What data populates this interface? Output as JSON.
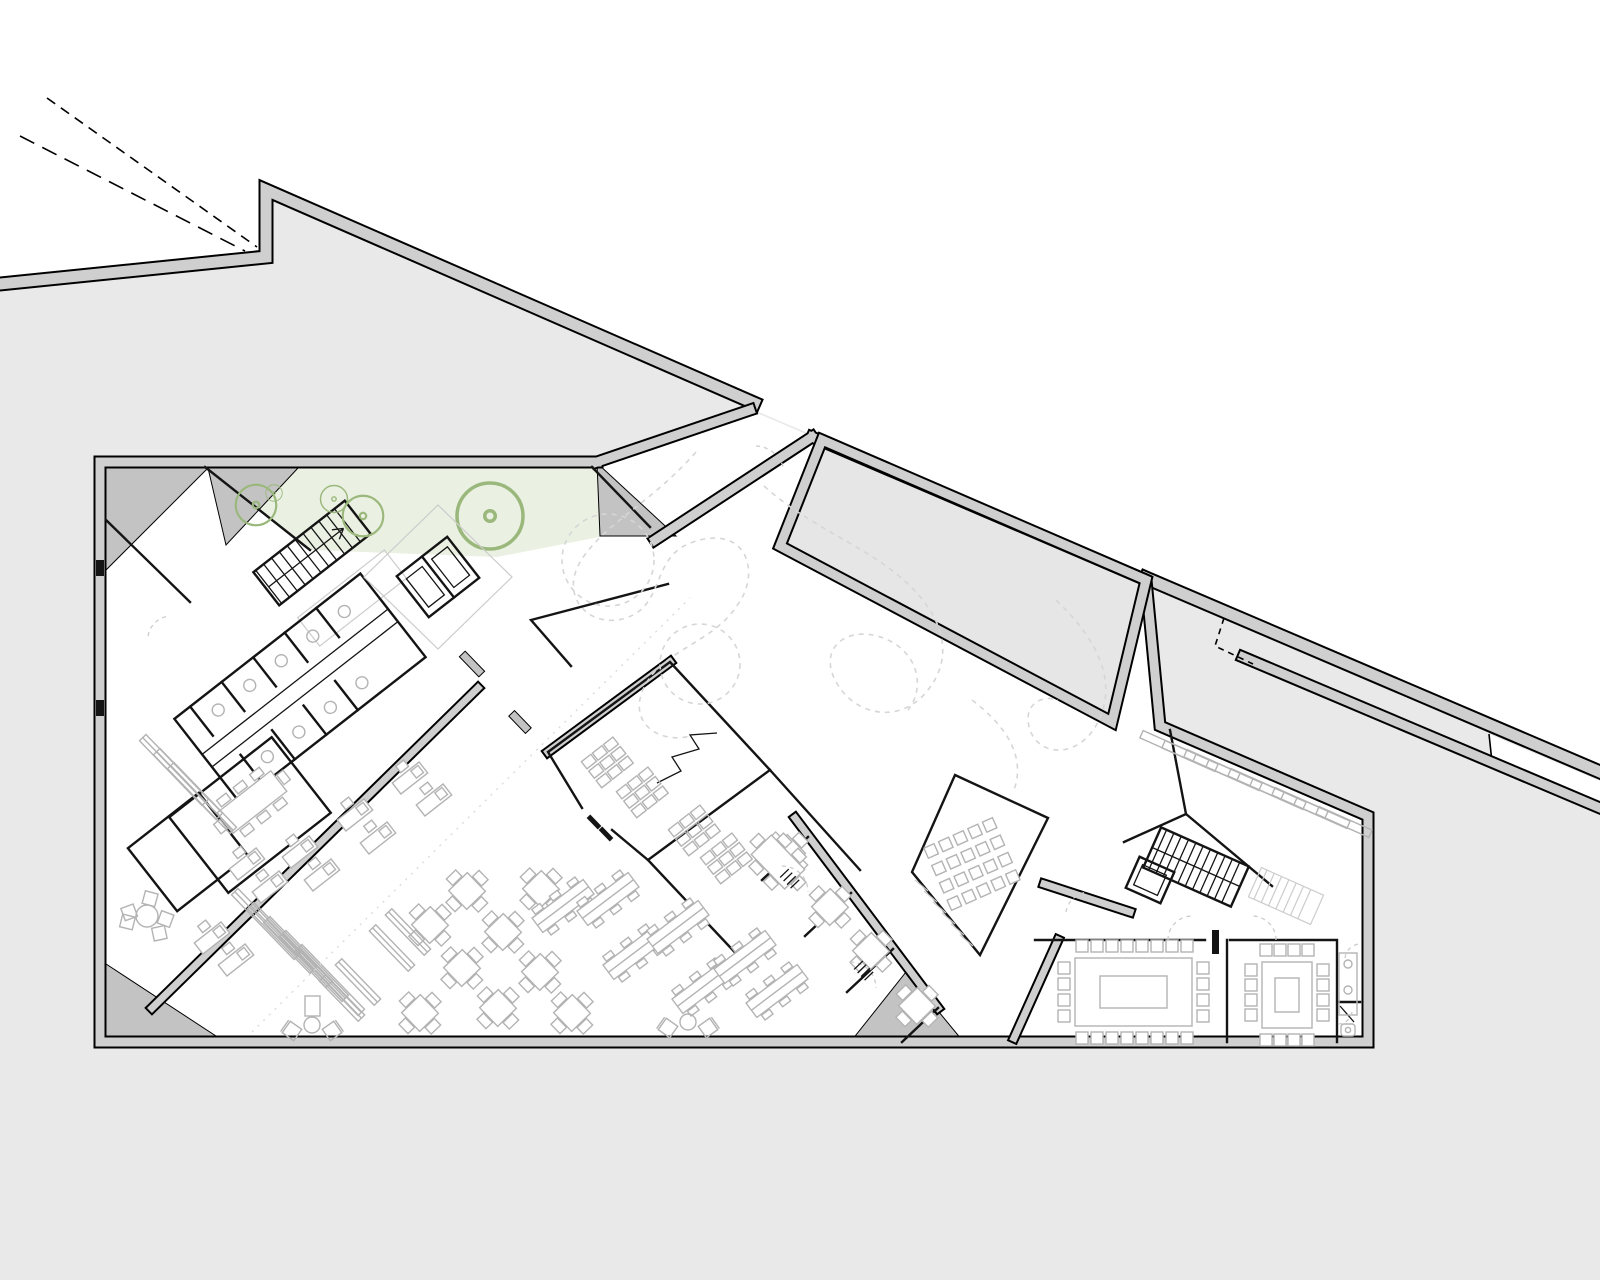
{
  "plan": {
    "label": "architectural-ground-floor-plan",
    "features": [
      "site-retaining-wall",
      "property-line",
      "entry-gap",
      "courtyard-void",
      "roof-garden-triangle",
      "stair-core-left",
      "elevator-pair-left",
      "toilet-block",
      "office-rooms",
      "reading-hall",
      "study-carrel-rooms",
      "group-study-strip-rooms",
      "auditorium-pod",
      "book-stacks-right-wing",
      "stair-core-right",
      "meeting-room-large",
      "meeting-room-small",
      "wc-strip"
    ]
  },
  "colors": {
    "background": "#ffffff",
    "site_ground": "#e9e9e9",
    "wall_band": "#cfcfcf",
    "wall_outline": "#000000",
    "building_fill": "#ffffff",
    "poche": "#c3c3c3",
    "courtyard_fill": "#e6e6e6",
    "garden_fill": "#eaf0e2",
    "tree_stroke": "#9bb87c",
    "furniture_stroke": "#b3b3b3",
    "ghost_stroke": "#cccccc",
    "meander_stroke": "#d6d6d6",
    "thin_wall": "#141414"
  },
  "furniture": {
    "tables4": {
      "sym": "sym-table4",
      "rot": 46,
      "pts": [
        [
          430,
          925
        ],
        [
          467,
          891
        ],
        [
          503,
          932
        ],
        [
          462,
          968
        ],
        [
          540,
          972
        ],
        [
          572,
          1013
        ],
        [
          420,
          1013
        ],
        [
          498,
          1008
        ],
        [
          541,
          889
        ],
        [
          830,
          907
        ],
        [
          871,
          951
        ],
        [
          917,
          1006
        ],
        [
          787,
          853
        ]
      ]
    },
    "tables6": {
      "sym": "sym-table6",
      "rot": 46,
      "pts": [
        [
          778,
          862
        ]
      ]
    },
    "conference": {
      "sym": "sym-table8",
      "rot": -38,
      "pts": [
        [
          252,
          802
        ]
      ]
    },
    "long_tables": {
      "sym": "sym-longtable",
      "rot": -37,
      "pts": [
        [
          563,
          906
        ],
        [
          608,
          899
        ],
        [
          634,
          953
        ],
        [
          678,
          927
        ],
        [
          703,
          987
        ],
        [
          745,
          957
        ],
        [
          777,
          991
        ]
      ]
    },
    "stacks": {
      "sym": "sym-stack",
      "rot": 46,
      "pts": [
        [
          342,
          998
        ],
        [
          358,
          982
        ],
        [
          392,
          948
        ],
        [
          408,
          932
        ]
      ]
    },
    "stacks_long": {
      "sym": "sym-stack2",
      "rot": 46,
      "pts": [
        [
          266,
          924
        ],
        [
          282,
          938
        ],
        [
          298,
          952
        ],
        [
          314,
          966
        ],
        [
          330,
          980
        ],
        [
          174,
          770
        ],
        [
          188,
          784
        ],
        [
          202,
          798
        ]
      ]
    },
    "wing_stacks": {
      "sym": "sym-wstack",
      "rot": 24,
      "pts": [
        [
          1168,
          746
        ],
        [
          1190,
          756
        ],
        [
          1212,
          765
        ],
        [
          1234,
          775
        ],
        [
          1256,
          784
        ],
        [
          1278,
          794
        ],
        [
          1300,
          803
        ],
        [
          1322,
          813
        ],
        [
          1344,
          822
        ]
      ]
    },
    "desks": {
      "sym": "sym-desk",
      "rot": -38,
      "pts": [
        [
          247,
          864
        ],
        [
          300,
          852
        ],
        [
          355,
          815
        ],
        [
          410,
          778
        ],
        [
          322,
          875
        ],
        [
          378,
          838
        ],
        [
          434,
          800
        ],
        [
          270,
          887
        ],
        [
          212,
          938
        ],
        [
          236,
          960
        ]
      ]
    },
    "carrels": {
      "sym": "sym-carrel",
      "rot": -38,
      "pts": [
        [
          607,
          762
        ],
        [
          642,
          792
        ],
        [
          694,
          830
        ],
        [
          726,
          858
        ]
      ]
    },
    "lounge_large": {
      "sym": "sym-lounge-l",
      "rot": 0,
      "pts": [
        [
          147,
          916
        ]
      ]
    },
    "lounge_small": {
      "sym": "sym-lounge-s",
      "rot": 0,
      "pts": [
        [
          312,
          1025
        ],
        [
          688,
          1022
        ]
      ]
    },
    "trees": {
      "sym": "sym-tree",
      "rot": 0,
      "pts": [
        [
          256,
          505,
          1.35
        ],
        [
          274,
          493,
          0.55
        ],
        [
          334,
          499,
          0.9
        ],
        [
          363,
          516,
          1.35
        ],
        [
          490,
          516,
          2.2
        ]
      ]
    }
  },
  "auditorium_seating": {
    "cx": 972,
    "cy": 864,
    "rot": -24,
    "rows": 4,
    "cols": 5,
    "dx": 16,
    "dy": 19,
    "size": 11
  },
  "meeting_rooms": [
    {
      "name": "meeting-room-large",
      "table": {
        "x": 1075,
        "y": 958,
        "w": 117,
        "h": 68,
        "ix": 1100,
        "iy": 976,
        "iw": 67,
        "ih": 32
      },
      "chairs": {
        "top": {
          "y": 946,
          "x0": 1082,
          "dx": 15,
          "n": 8
        },
        "bottom": {
          "y": 1038,
          "x0": 1082,
          "dx": 15,
          "n": 8
        },
        "left": {
          "x": 1064,
          "y0": 968,
          "dy": 16,
          "n": 4
        },
        "right": {
          "x": 1203,
          "y0": 968,
          "dy": 16,
          "n": 4
        }
      }
    },
    {
      "name": "meeting-room-small",
      "table": {
        "x": 1262,
        "y": 962,
        "w": 50,
        "h": 66,
        "ix": 1275,
        "iy": 978,
        "iw": 24,
        "ih": 34
      },
      "chairs": {
        "top": {
          "y": 950,
          "x0": 1266,
          "dx": 14,
          "n": 4
        },
        "bottom": {
          "y": 1040,
          "x0": 1266,
          "dx": 14,
          "n": 4
        },
        "left": {
          "x": 1251,
          "y0": 970,
          "dy": 15,
          "n": 4
        },
        "right": {
          "x": 1323,
          "y0": 970,
          "dy": 15,
          "n": 4
        }
      }
    }
  ]
}
